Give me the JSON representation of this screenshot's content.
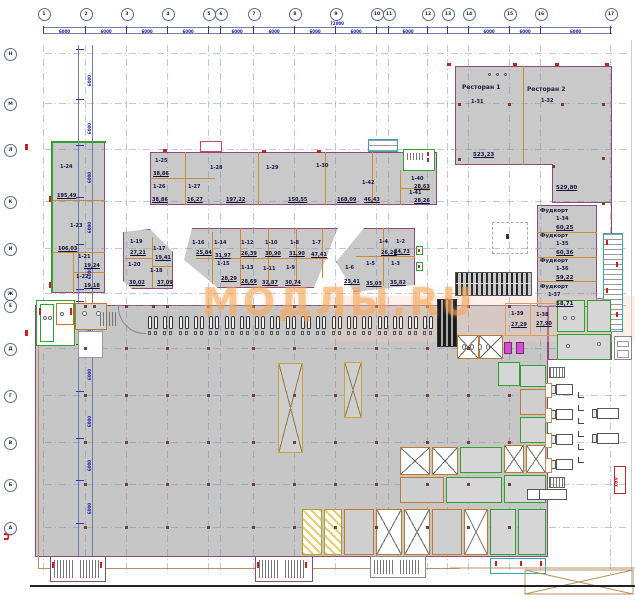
{
  "watermark": {
    "text": "МОДЛЫ.RU"
  },
  "revision_mark": "Ч",
  "stamp": "АВТ",
  "grid": {
    "seg_dim": "6000",
    "total_dim": "72000",
    "top": [
      {
        "l": "1",
        "x": 43
      },
      {
        "l": "2",
        "x": 85
      },
      {
        "l": "3",
        "x": 126
      },
      {
        "l": "4",
        "x": 167
      },
      {
        "l": "5",
        "x": 208
      },
      {
        "l": "6",
        "x": 220
      },
      {
        "l": "7",
        "x": 253
      },
      {
        "l": "8",
        "x": 294
      },
      {
        "l": "9",
        "x": 335
      },
      {
        "l": "10",
        "x": 376
      },
      {
        "l": "11",
        "x": 388
      },
      {
        "l": "12",
        "x": 427
      },
      {
        "l": "13",
        "x": 447
      },
      {
        "l": "14",
        "x": 468
      },
      {
        "l": "15",
        "x": 509
      },
      {
        "l": "16",
        "x": 540
      },
      {
        "l": "17",
        "x": 610
      }
    ],
    "left": [
      {
        "l": "Н",
        "y": 53
      },
      {
        "l": "М",
        "y": 103
      },
      {
        "l": "Л",
        "y": 149
      },
      {
        "l": "К",
        "y": 201
      },
      {
        "l": "И",
        "y": 248
      },
      {
        "l": "Ж",
        "y": 293
      },
      {
        "l": "Е",
        "y": 305
      },
      {
        "l": "Д",
        "y": 348
      },
      {
        "l": "Г",
        "y": 395
      },
      {
        "l": "В",
        "y": 442
      },
      {
        "l": "Б",
        "y": 484
      },
      {
        "l": "А",
        "y": 527
      }
    ]
  },
  "named_rooms": [
    {
      "name": "Ресторан 1",
      "id": "1-31",
      "area": "523,23",
      "np": [
        462,
        84
      ],
      "ip": [
        471,
        100
      ],
      "ap": [
        473,
        152
      ]
    },
    {
      "name": "Ресторан 2",
      "id": "1-32",
      "area": "529,80",
      "np": [
        527,
        86
      ],
      "ip": [
        541,
        99
      ],
      "ap": [
        556,
        185
      ]
    },
    {
      "name": "Фудкорт",
      "id": "1-34",
      "area": "60,25",
      "np": [
        540,
        208
      ],
      "ip": [
        556,
        217
      ],
      "ap": [
        556,
        225
      ]
    },
    {
      "name": "Фудкорт",
      "id": "1-35",
      "area": "60,36",
      "np": [
        540,
        233
      ],
      "ip": [
        556,
        242
      ],
      "ap": [
        556,
        250
      ]
    },
    {
      "name": "Фудкорт",
      "id": "1-36",
      "area": "59,22",
      "np": [
        540,
        258
      ],
      "ip": [
        556,
        267
      ],
      "ap": [
        556,
        275
      ]
    },
    {
      "name": "Фудкорт",
      "id": "1-37",
      "area": "58,71",
      "np": [
        540,
        284
      ],
      "ip": [
        548,
        293
      ],
      "ap": [
        556,
        301
      ]
    }
  ],
  "units": [
    {
      "id": "1-24",
      "area": "195,49",
      "ip": [
        60,
        165
      ],
      "ap": [
        57,
        194
      ]
    },
    {
      "id": "1-23",
      "area": "106,03",
      "ip": [
        70,
        224
      ],
      "ap": [
        58,
        247
      ]
    },
    {
      "id": "1-21",
      "area": "19,24",
      "ip": [
        78,
        255
      ],
      "ap": [
        84,
        264
      ]
    },
    {
      "id": "1-22",
      "area": "19,18",
      "ip": [
        76,
        275
      ],
      "ap": [
        84,
        284
      ]
    },
    {
      "id": "1-25",
      "area": "38,86",
      "ip": [
        155,
        159
      ],
      "ap": [
        153,
        172
      ]
    },
    {
      "id": "1-26",
      "area": "38,86",
      "ip": [
        153,
        185
      ],
      "ap": [
        152,
        198
      ]
    },
    {
      "id": "1-27",
      "area": "16,27",
      "ip": [
        188,
        185
      ],
      "ap": [
        187,
        198
      ]
    },
    {
      "id": "1-28",
      "area": "197,22",
      "ip": [
        210,
        166
      ],
      "ap": [
        226,
        198
      ]
    },
    {
      "id": "1-29",
      "area": "150,55",
      "ip": [
        266,
        166
      ],
      "ap": [
        288,
        198
      ]
    },
    {
      "id": "1-30",
      "area": "168,09",
      "ip": [
        316,
        164
      ],
      "ap": [
        337,
        198
      ]
    },
    {
      "id": "1-42",
      "area": "46,43",
      "ip": [
        362,
        181
      ],
      "ap": [
        364,
        198
      ]
    },
    {
      "id": "1-40",
      "area": "28,63",
      "ip": [
        411,
        177
      ],
      "ap": [
        414,
        185
      ]
    },
    {
      "id": "1-41",
      "area": "28,26",
      "ip": [
        409,
        191
      ],
      "ap": [
        414,
        199
      ]
    },
    {
      "id": "1-19",
      "area": "27,21",
      "ip": [
        130,
        240
      ],
      "ap": [
        130,
        251
      ]
    },
    {
      "id": "1-20",
      "area": "30,02",
      "ip": [
        128,
        263
      ],
      "ap": [
        129,
        281
      ]
    },
    {
      "id": "1-17",
      "area": "19,41",
      "ip": [
        153,
        247
      ],
      "ap": [
        155,
        256
      ]
    },
    {
      "id": "1-18",
      "area": "37,09",
      "ip": [
        150,
        269
      ],
      "ap": [
        157,
        281
      ]
    },
    {
      "id": "1-16",
      "area": "25,84",
      "ip": [
        192,
        241
      ],
      "ap": [
        196,
        251
      ]
    },
    {
      "id": "1-14",
      "area": "31,97",
      "ip": [
        214,
        241
      ],
      "ap": [
        215,
        254
      ]
    },
    {
      "id": "1-12",
      "area": "26,39",
      "ip": [
        241,
        241
      ],
      "ap": [
        241,
        252
      ]
    },
    {
      "id": "1-10",
      "area": "30,90",
      "ip": [
        265,
        241
      ],
      "ap": [
        265,
        252
      ]
    },
    {
      "id": "1-8",
      "area": "31,90",
      "ip": [
        290,
        241
      ],
      "ap": [
        289,
        252
      ]
    },
    {
      "id": "1-7",
      "area": "47,41",
      "ip": [
        312,
        241
      ],
      "ap": [
        311,
        253
      ]
    },
    {
      "id": "1-15",
      "area": "28,29",
      "ip": [
        217,
        262
      ],
      "ap": [
        221,
        277
      ]
    },
    {
      "id": "1-13",
      "area": "28,69",
      "ip": [
        241,
        266
      ],
      "ap": [
        241,
        280
      ]
    },
    {
      "id": "1-11",
      "area": "32,87",
      "ip": [
        263,
        267
      ],
      "ap": [
        262,
        281
      ]
    },
    {
      "id": "1-9",
      "area": "30,74",
      "ip": [
        286,
        266
      ],
      "ap": [
        285,
        281
      ]
    },
    {
      "id": "1-6",
      "area": "23,41",
      "ip": [
        345,
        266
      ],
      "ap": [
        344,
        280
      ]
    },
    {
      "id": "1-5",
      "area": "35,03",
      "ip": [
        366,
        262
      ],
      "ap": [
        366,
        282
      ]
    },
    {
      "id": "1-4",
      "area": "26,20",
      "ip": [
        379,
        240
      ],
      "ap": [
        381,
        251
      ]
    },
    {
      "id": "1-3",
      "area": "35,82",
      "ip": [
        391,
        262
      ],
      "ap": [
        390,
        281
      ]
    },
    {
      "id": "1-2",
      "area": "24,73",
      "ip": [
        396,
        240
      ],
      "ap": [
        394,
        250
      ]
    },
    {
      "id": "1-39",
      "area": "27,29",
      "ip": [
        511,
        312
      ],
      "ap": [
        511,
        323
      ]
    },
    {
      "id": "1-38",
      "area": "27,90",
      "ip": [
        536,
        313
      ],
      "ap": [
        536,
        322
      ]
    }
  ],
  "boh_rooms": [
    [
      400,
      447,
      30,
      28,
      "x"
    ],
    [
      432,
      447,
      26,
      28,
      "x"
    ],
    [
      460,
      447,
      42,
      26,
      "g"
    ],
    [
      504,
      445,
      20,
      28,
      "x"
    ],
    [
      526,
      445,
      20,
      28,
      "x"
    ],
    [
      400,
      477,
      44,
      26,
      "p"
    ],
    [
      446,
      477,
      56,
      26,
      "g"
    ],
    [
      504,
      475,
      42,
      28,
      "g"
    ],
    [
      302,
      509,
      20,
      46,
      "y"
    ],
    [
      324,
      509,
      18,
      46,
      "y"
    ],
    [
      344,
      509,
      30,
      46,
      "p"
    ],
    [
      376,
      509,
      26,
      46,
      "x"
    ],
    [
      404,
      509,
      26,
      46,
      "x"
    ],
    [
      432,
      509,
      30,
      46,
      "p"
    ],
    [
      464,
      509,
      24,
      46,
      "x"
    ],
    [
      490,
      509,
      26,
      46,
      "g"
    ],
    [
      518,
      509,
      28,
      46,
      "g"
    ],
    [
      520,
      365,
      26,
      22,
      "g"
    ],
    [
      520,
      389,
      26,
      26,
      "p"
    ],
    [
      520,
      417,
      26,
      26,
      "g"
    ],
    [
      457,
      335,
      22,
      24,
      "x"
    ],
    [
      479,
      335,
      24,
      24,
      "x"
    ],
    [
      557,
      300,
      28,
      32,
      "g"
    ],
    [
      587,
      300,
      24,
      32,
      "g"
    ],
    [
      557,
      334,
      54,
      26,
      "g"
    ],
    [
      498,
      362,
      22,
      24,
      "g"
    ]
  ],
  "checkouts": {
    "count": 19,
    "x0": 147,
    "step": 15.3,
    "y": 310
  },
  "columns": {
    "xs": [
      85,
      126,
      167,
      208,
      253,
      294,
      335,
      376,
      427,
      468,
      509
    ],
    "ys": [
      306,
      348,
      395,
      442,
      484,
      527
    ],
    "extra": [
      [
        459,
        104
      ],
      [
        509,
        104
      ],
      [
        562,
        104
      ],
      [
        603,
        104
      ],
      [
        459,
        159
      ],
      [
        553,
        166
      ],
      [
        603,
        158
      ],
      [
        603,
        203
      ],
      [
        94,
        306
      ],
      [
        153,
        306
      ]
    ]
  },
  "red_marks": [
    [
      163,
      149,
      4,
      3
    ],
    [
      262,
      150,
      4,
      3
    ],
    [
      317,
      150,
      4,
      3
    ],
    [
      447,
      63,
      4,
      3
    ],
    [
      513,
      63,
      4,
      3
    ],
    [
      555,
      63,
      4,
      3
    ],
    [
      605,
      63,
      4,
      3
    ],
    [
      49,
      196,
      2,
      6
    ],
    [
      49,
      282,
      2,
      6
    ],
    [
      39,
      308,
      2,
      7
    ],
    [
      70,
      308,
      2,
      7
    ],
    [
      606,
      240,
      2,
      5
    ],
    [
      616,
      262,
      2,
      5
    ],
    [
      606,
      288,
      2,
      5
    ],
    [
      616,
      312,
      2,
      5
    ],
    [
      25,
      144,
      3,
      6
    ],
    [
      25,
      330,
      3,
      6
    ],
    [
      495,
      561,
      2,
      5
    ],
    [
      520,
      561,
      2,
      5
    ],
    [
      540,
      561,
      2,
      5
    ],
    [
      52,
      562,
      2,
      6
    ],
    [
      100,
      562,
      2,
      6
    ],
    [
      257,
      562,
      2,
      6
    ],
    [
      305,
      562,
      2,
      6
    ],
    [
      418,
      249,
      2,
      3
    ],
    [
      418,
      265,
      2,
      3
    ],
    [
      427,
      152,
      2,
      4
    ],
    [
      427,
      158,
      2,
      4
    ]
  ],
  "trucks": {
    "dock_y": [
      384,
      409,
      434,
      459
    ],
    "far": [
      [
        592,
        408
      ],
      [
        592,
        433
      ]
    ]
  },
  "brackets_y": [
    392,
    405,
    418,
    431,
    444,
    457
  ],
  "dock_doors_y": [
    384,
    409,
    434,
    459
  ]
}
